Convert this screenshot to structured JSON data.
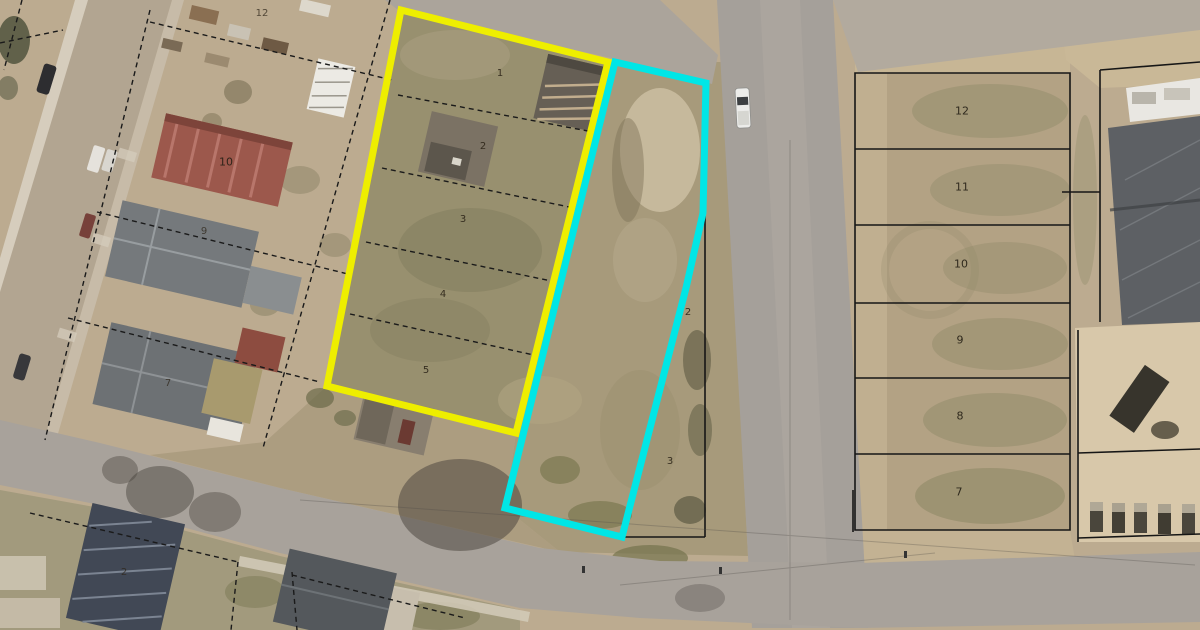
{
  "map": {
    "colors": {
      "primary_highlight": "#eeee00",
      "secondary_highlight": "#00e6e6",
      "parcel_line": "#161616"
    },
    "lots": {
      "yellow_parcel": [
        "1",
        "2",
        "3",
        "4",
        "5"
      ],
      "cyan_parcel": [
        "2",
        "3"
      ],
      "east_block": [
        "12",
        "11",
        "10",
        "9",
        "8",
        "7"
      ],
      "west_block": [
        "12",
        "10",
        "9",
        "7",
        "2"
      ]
    }
  }
}
